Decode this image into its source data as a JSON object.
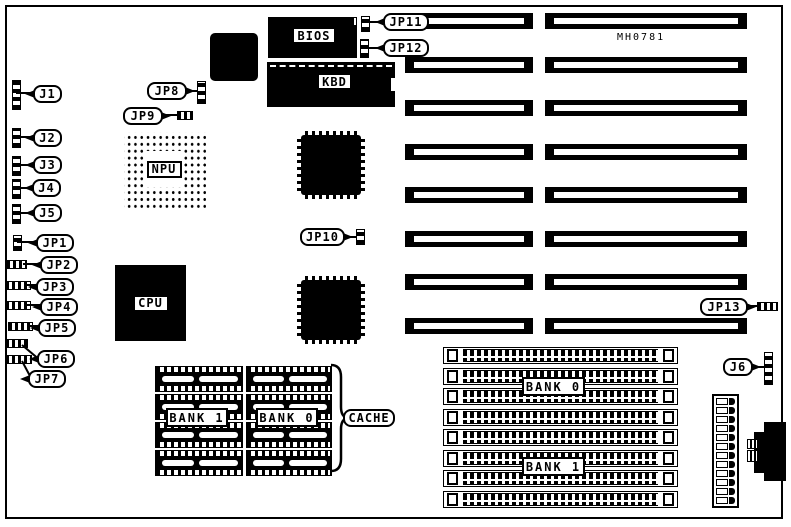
{
  "board": {
    "part_number": "MH0781"
  },
  "chips": {
    "bios": "BIOS",
    "kbd": "KBD",
    "npu": "NPU",
    "cpu": "CPU"
  },
  "connectors": {
    "j1": "J1",
    "j2": "J2",
    "j3": "J3",
    "j4": "J4",
    "j5": "J5",
    "j6": "J6"
  },
  "jumpers": {
    "jp1": "JP1",
    "jp2": "JP2",
    "jp3": "JP3",
    "jp4": "JP4",
    "jp5": "JP5",
    "jp6": "JP6",
    "jp7": "JP7",
    "jp8": "JP8",
    "jp9": "JP9",
    "jp10": "JP10",
    "jp11": "JP11",
    "jp12": "JP12",
    "jp13": "JP13"
  },
  "cache": {
    "label": "CACHE",
    "bank1": "BANK 1",
    "bank0": "BANK 0"
  },
  "simm": {
    "bank0": "BANK 0",
    "bank1": "BANK 1"
  }
}
